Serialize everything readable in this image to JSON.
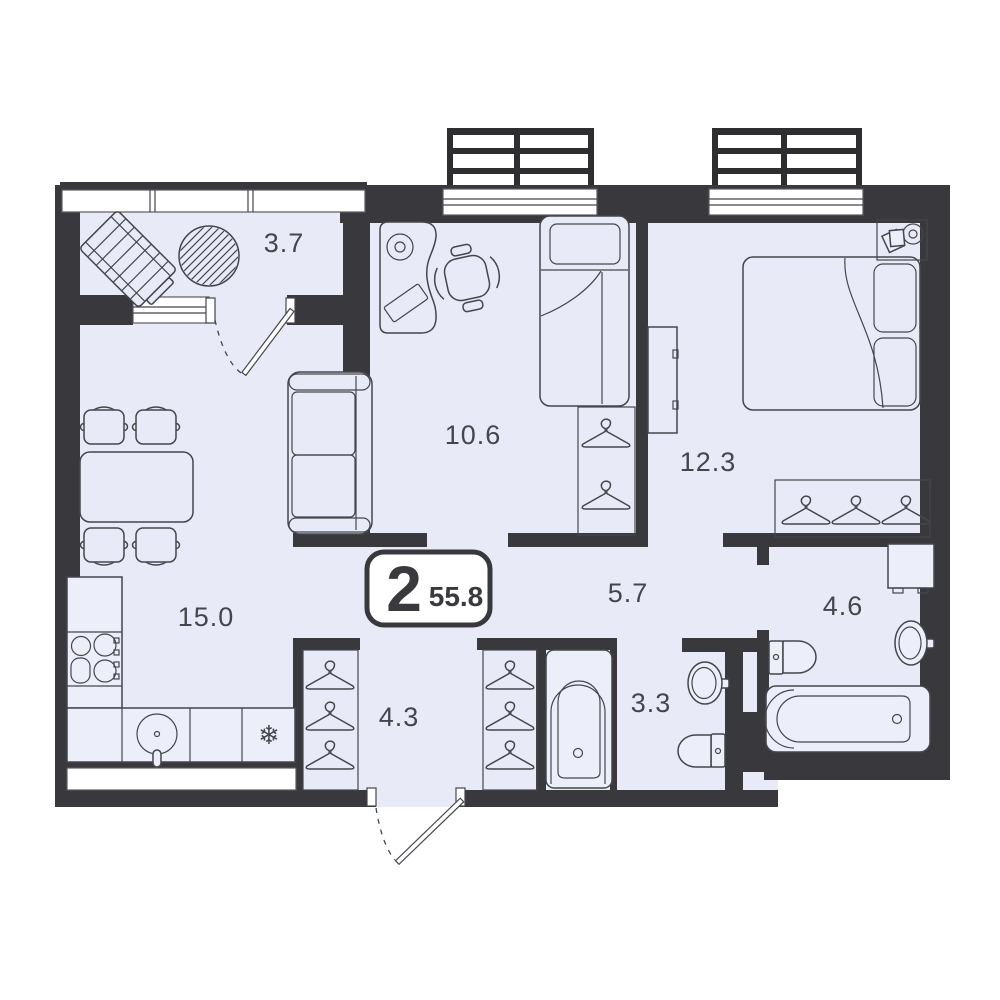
{
  "plan": {
    "badge": {
      "rooms": "2",
      "area": "55.8"
    },
    "rooms": [
      {
        "name": "balcony",
        "area": "3.7"
      },
      {
        "name": "kitchen-living-room",
        "area": "15.0"
      },
      {
        "name": "bedroom-children",
        "area": "10.6"
      },
      {
        "name": "bedroom-master",
        "area": "12.3"
      },
      {
        "name": "corridor",
        "area": "5.7"
      },
      {
        "name": "hallway",
        "area": "4.3"
      },
      {
        "name": "bathroom",
        "area": "3.3"
      },
      {
        "name": "bathroom-second",
        "area": "4.6"
      }
    ],
    "symbols": {
      "fridge": "❄"
    },
    "colors": {
      "wall": "#39393d",
      "floor": "#e8ebf7",
      "line": "#45464c",
      "background": "#ffffff"
    }
  }
}
